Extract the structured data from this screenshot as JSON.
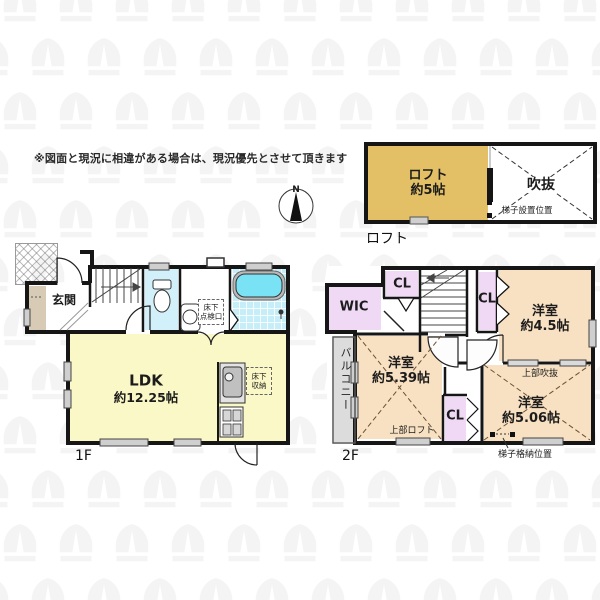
{
  "disclaimer": "※図面と現況に相違がある場合は、現況優先とさせて頂きます",
  "compass": {
    "north": "N"
  },
  "loft_plan": {
    "caption": "ロフト",
    "room_loft": {
      "name": "ロフト",
      "size": "約5帖"
    },
    "void_label": "吹抜",
    "ladder_note": "梯子設置位置"
  },
  "floor1": {
    "caption": "1F",
    "genkan": "玄関",
    "ldk": {
      "name": "LDK",
      "size": "約12.25帖"
    },
    "underfloor_access": {
      "line1": "床下",
      "line2": "点検口"
    },
    "underfloor_storage": {
      "line1": "床下",
      "line2": "収納"
    }
  },
  "floor2": {
    "caption": "2F",
    "wic": "WIC",
    "cl_top": "CL",
    "cl_right": "CL",
    "cl_bottom": "CL",
    "bedroom_45": {
      "name": "洋室",
      "size": "約4.5帖"
    },
    "bedroom_539": {
      "name": "洋室",
      "size": "約5.39帖"
    },
    "bedroom_506": {
      "name": "洋室",
      "size": "約5.06帖"
    },
    "balcony": "バルコニー",
    "upper_void": "上部吹抜",
    "upper_loft": "上部ロフト",
    "ladder_storage": "梯子格納位置"
  },
  "colors": {
    "wall": "#161616",
    "ldk_yellow": "#FAF8C6",
    "loft_tan": "#E3C065",
    "bedroom_peach": "#F8E0C2",
    "closet_lavender": "#EFD9F5",
    "bath_cyan": "#C6EEF8",
    "tub_cyan": "#79E2F4",
    "toilet_cyan": "#D2F0F9",
    "genkan_beige": "#D8CBB6",
    "balcony_gray": "#DCDCDC"
  }
}
